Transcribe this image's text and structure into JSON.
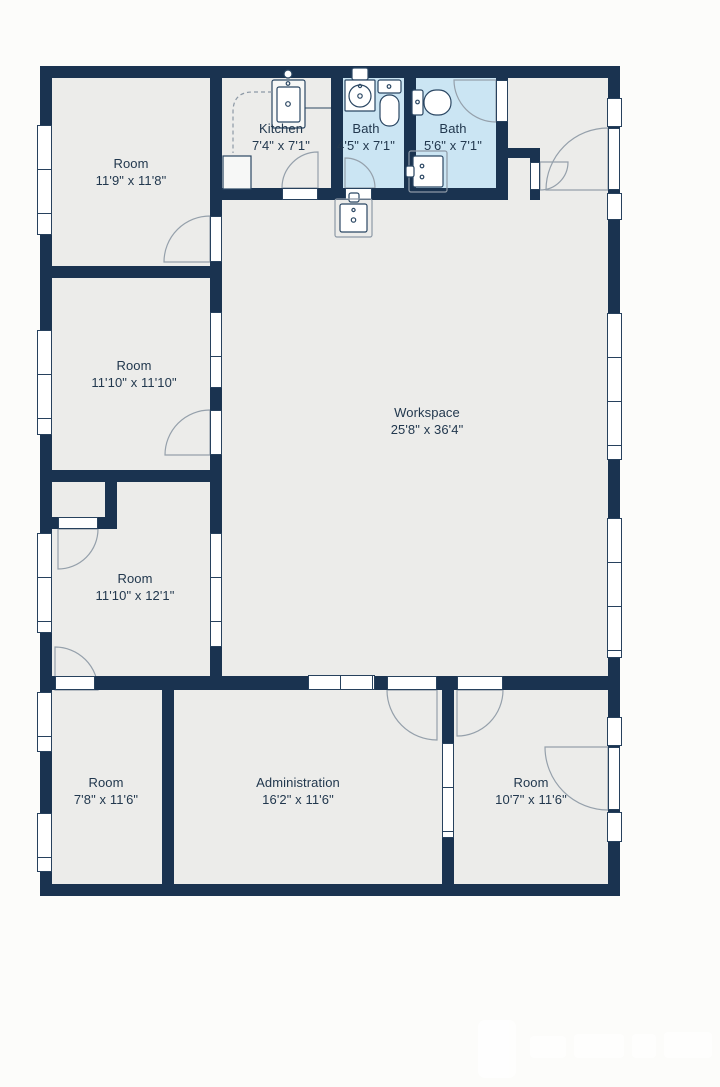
{
  "rooms": [
    {
      "name": "Room",
      "dims": "11'9\" x 11'8\""
    },
    {
      "name": "Kitchen",
      "dims": "7'4\" x 7'1\""
    },
    {
      "name": "Bath",
      "dims": "4'5\" x 7'1\""
    },
    {
      "name": "Bath",
      "dims": "5'6\" x 7'1\""
    },
    {
      "name": "Workspace",
      "dims": "25'8\" x 36'4\""
    },
    {
      "name": "Room",
      "dims": "11'10\" x 11'10\""
    },
    {
      "name": "Room",
      "dims": "11'10\" x 12'1\""
    },
    {
      "name": "Room",
      "dims": "7'8\" x 11'6\""
    },
    {
      "name": "Administration",
      "dims": "16'2\" x 11'6\""
    },
    {
      "name": "Room",
      "dims": "10'7\" x 11'6\""
    }
  ],
  "colors": {
    "wall": "#1a3350",
    "floor": "#ececea",
    "bath_floor": "#cbe5f3",
    "background": "#fcfcfa",
    "label_text": "#22384e",
    "door_arc": "#95a0ab"
  },
  "fixtures": [
    "kitchen-sink",
    "kitchen-counter",
    "vanity-round-sink",
    "toilet",
    "toilet",
    "bath-sink",
    "utility-sink"
  ]
}
